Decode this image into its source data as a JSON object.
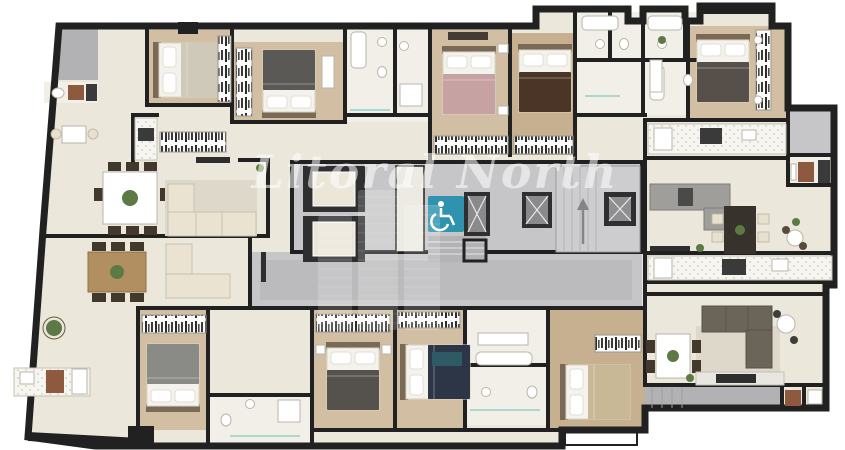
{
  "watermark": {
    "text": "Litoral North"
  },
  "icons": {
    "accessibility": "wheelchair-icon",
    "stairs_direction": "up-arrow-icon",
    "elevator": "elevator-x-icon"
  },
  "elements": [
    "double-bed",
    "wardrobe",
    "sofa",
    "dining-table",
    "kitchen-counter",
    "bathtub",
    "toilet",
    "sink",
    "elevator",
    "accessible-elevator",
    "staircase",
    "washer",
    "plant",
    "tv",
    "balcony",
    "rug"
  ],
  "colors": {
    "wall": "#212121",
    "floor": "#ebe7da",
    "wood": "#d2bfa3",
    "wood2": "#c6b08f",
    "corridor": "#c6c6c8",
    "corridor2": "#b2b2b4",
    "bath": "#f1efe8",
    "accent": "#2f92ae",
    "bedPink": "#c7a2a2",
    "bedNavy": "#2d3646",
    "bedBrown": "#4a3526",
    "bedGray": "#57504a",
    "bedBeige": "#c9b896",
    "sofaCream": "#eae3d2",
    "sofaGray": "#a09e9a",
    "sofaBrown": "#6b6458",
    "tableWood": "#b28f60",
    "tableDark": "#37322c",
    "plant": "#5d7a46",
    "appliance": "#8d5a3f",
    "rug": "#ddd8ca",
    "watermark": "rgba(255,255,255,0.55)"
  }
}
